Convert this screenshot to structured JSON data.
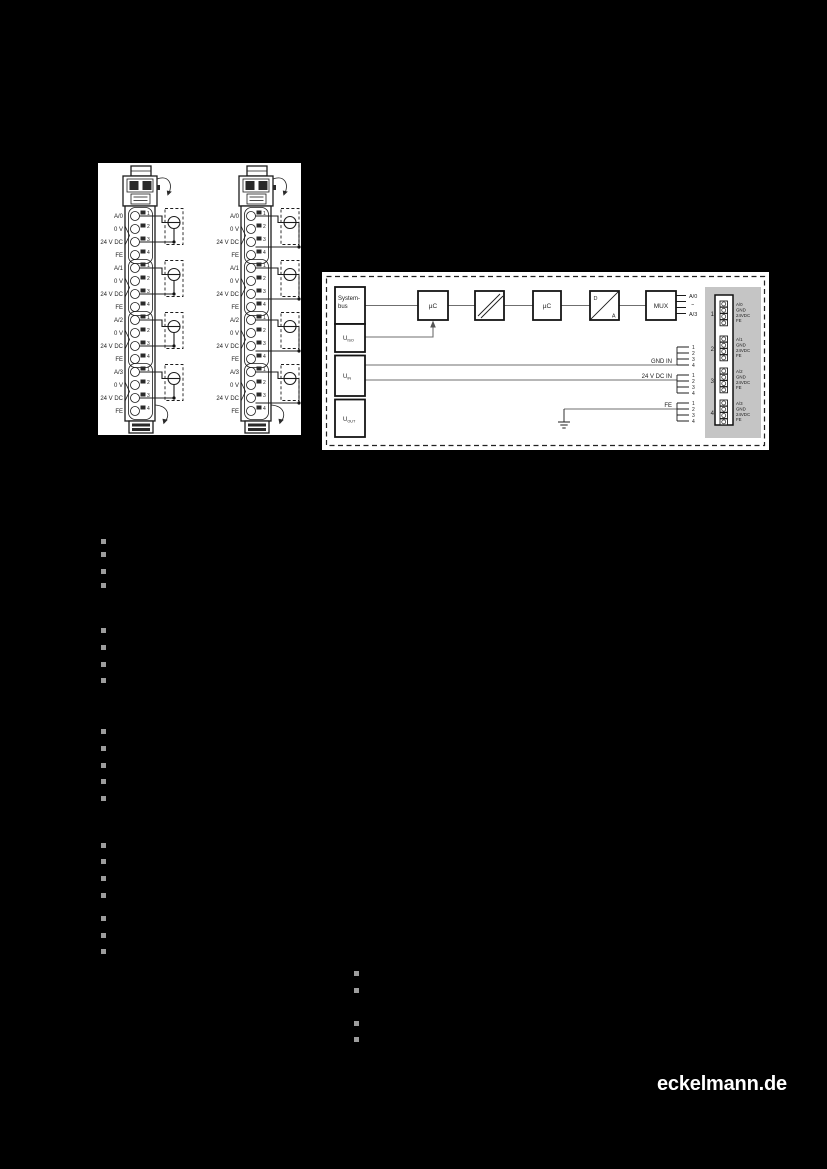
{
  "page": {
    "logo": "eckelmann.de"
  },
  "colors": {
    "page_bg": "#000000",
    "figure_bg": "#ffffff",
    "line_black": "#1c1c1c",
    "signal_gray": "#6f6f6f",
    "panel_gray": "#c5c5c5",
    "bullet_gray": "#9d9d9d",
    "logo_white": "#ffffff"
  },
  "wiring_figure": {
    "terminal_numbers": [
      "1",
      "2",
      "3",
      "4"
    ],
    "groups": [
      {
        "labels": [
          "A/0",
          "0 V",
          "24 V DC",
          "FE"
        ]
      },
      {
        "labels": [
          "A/1",
          "0 V",
          "24 V DC",
          "FE"
        ]
      },
      {
        "labels": [
          "A/2",
          "0 V",
          "24 V DC",
          "FE"
        ]
      },
      {
        "labels": [
          "A/3",
          "0 V",
          "24 V DC",
          "FE"
        ]
      }
    ]
  },
  "block_diagram": {
    "supply": {
      "system_line1": "System-",
      "system_line2": "bus",
      "u_iso": {
        "base": "U",
        "sub": "ISO"
      },
      "u_in": {
        "base": "U",
        "sub": "IN"
      },
      "u_out": {
        "base": "U",
        "sub": "OUT"
      }
    },
    "uc1": "µC",
    "uc2": "µC",
    "mux": "MUX",
    "da": {
      "d": "D",
      "a": "A"
    },
    "mux_outputs": {
      "top": "A/0",
      "mid": "~",
      "bottom": "A/3"
    },
    "signals": {
      "gnd": "GND IN",
      "vdc": "24 V DC IN",
      "fe": "FE"
    },
    "fan_numbers": [
      "1",
      "2",
      "3",
      "4"
    ],
    "connector_groups": [
      {
        "number": "1",
        "pins": [
          "A/0",
          "GND",
          "24VDC",
          "FE"
        ]
      },
      {
        "number": "2",
        "pins": [
          "A/1",
          "GND",
          "24VDC",
          "FE"
        ]
      },
      {
        "number": "3",
        "pins": [
          "A/2",
          "GND",
          "24VDC",
          "FE"
        ]
      },
      {
        "number": "4",
        "pins": [
          "A/3",
          "GND",
          "24VDC",
          "FE"
        ]
      }
    ]
  }
}
